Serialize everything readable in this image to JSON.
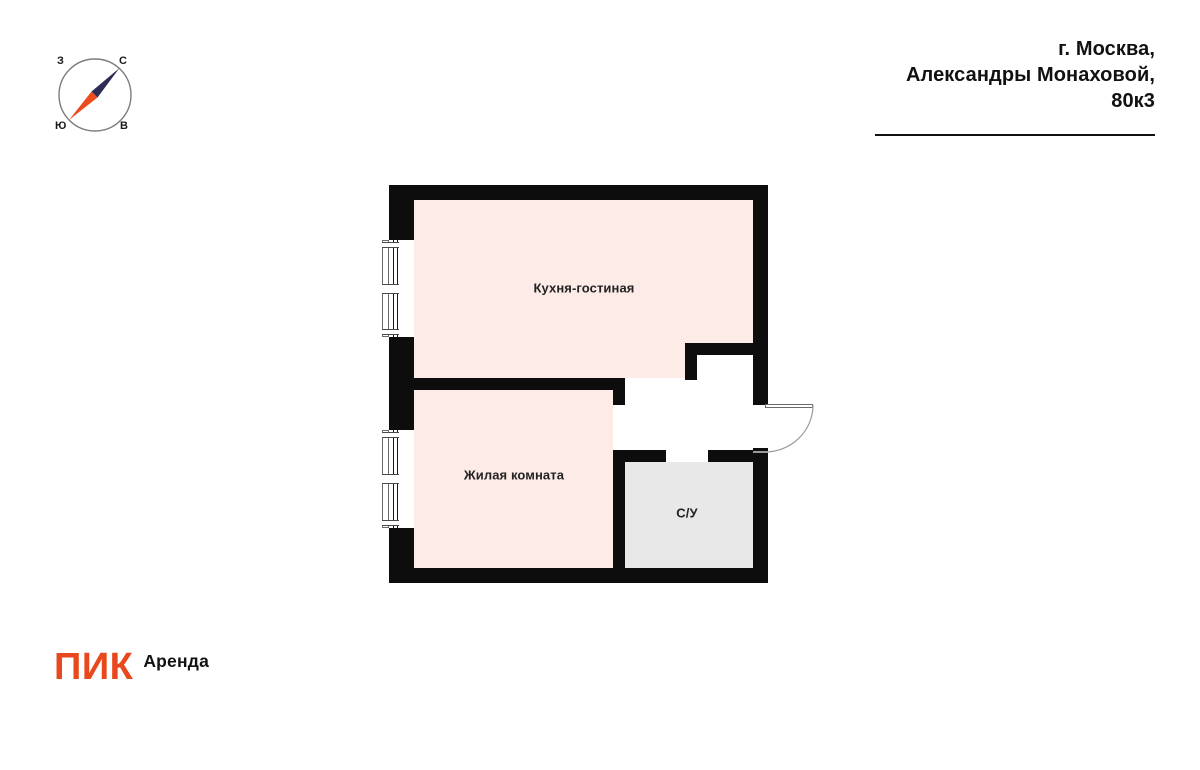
{
  "compass": {
    "west": "З",
    "north": "С",
    "south": "Ю",
    "east": "В"
  },
  "header": {
    "line1": "г. Москва,",
    "line2": "Александры Монаховой, 80к3"
  },
  "plan": {
    "rooms": [
      {
        "name": "Кухня-гостиная",
        "type": "kitchen-living"
      },
      {
        "name": "Жилая комната",
        "type": "living-room"
      },
      {
        "name": "С/У",
        "type": "bathroom"
      }
    ]
  },
  "footer": {
    "logo": "ПИК",
    "logo_suffix": "Аренда"
  },
  "colors": {
    "wall": "#0d0d0d",
    "room_pink": "#fcebe7",
    "room_gray": "#e8e8e8",
    "brand_orange": "#e8481c",
    "needle_navy": "#2e2b55",
    "needle_orange": "#ed4b1e"
  }
}
